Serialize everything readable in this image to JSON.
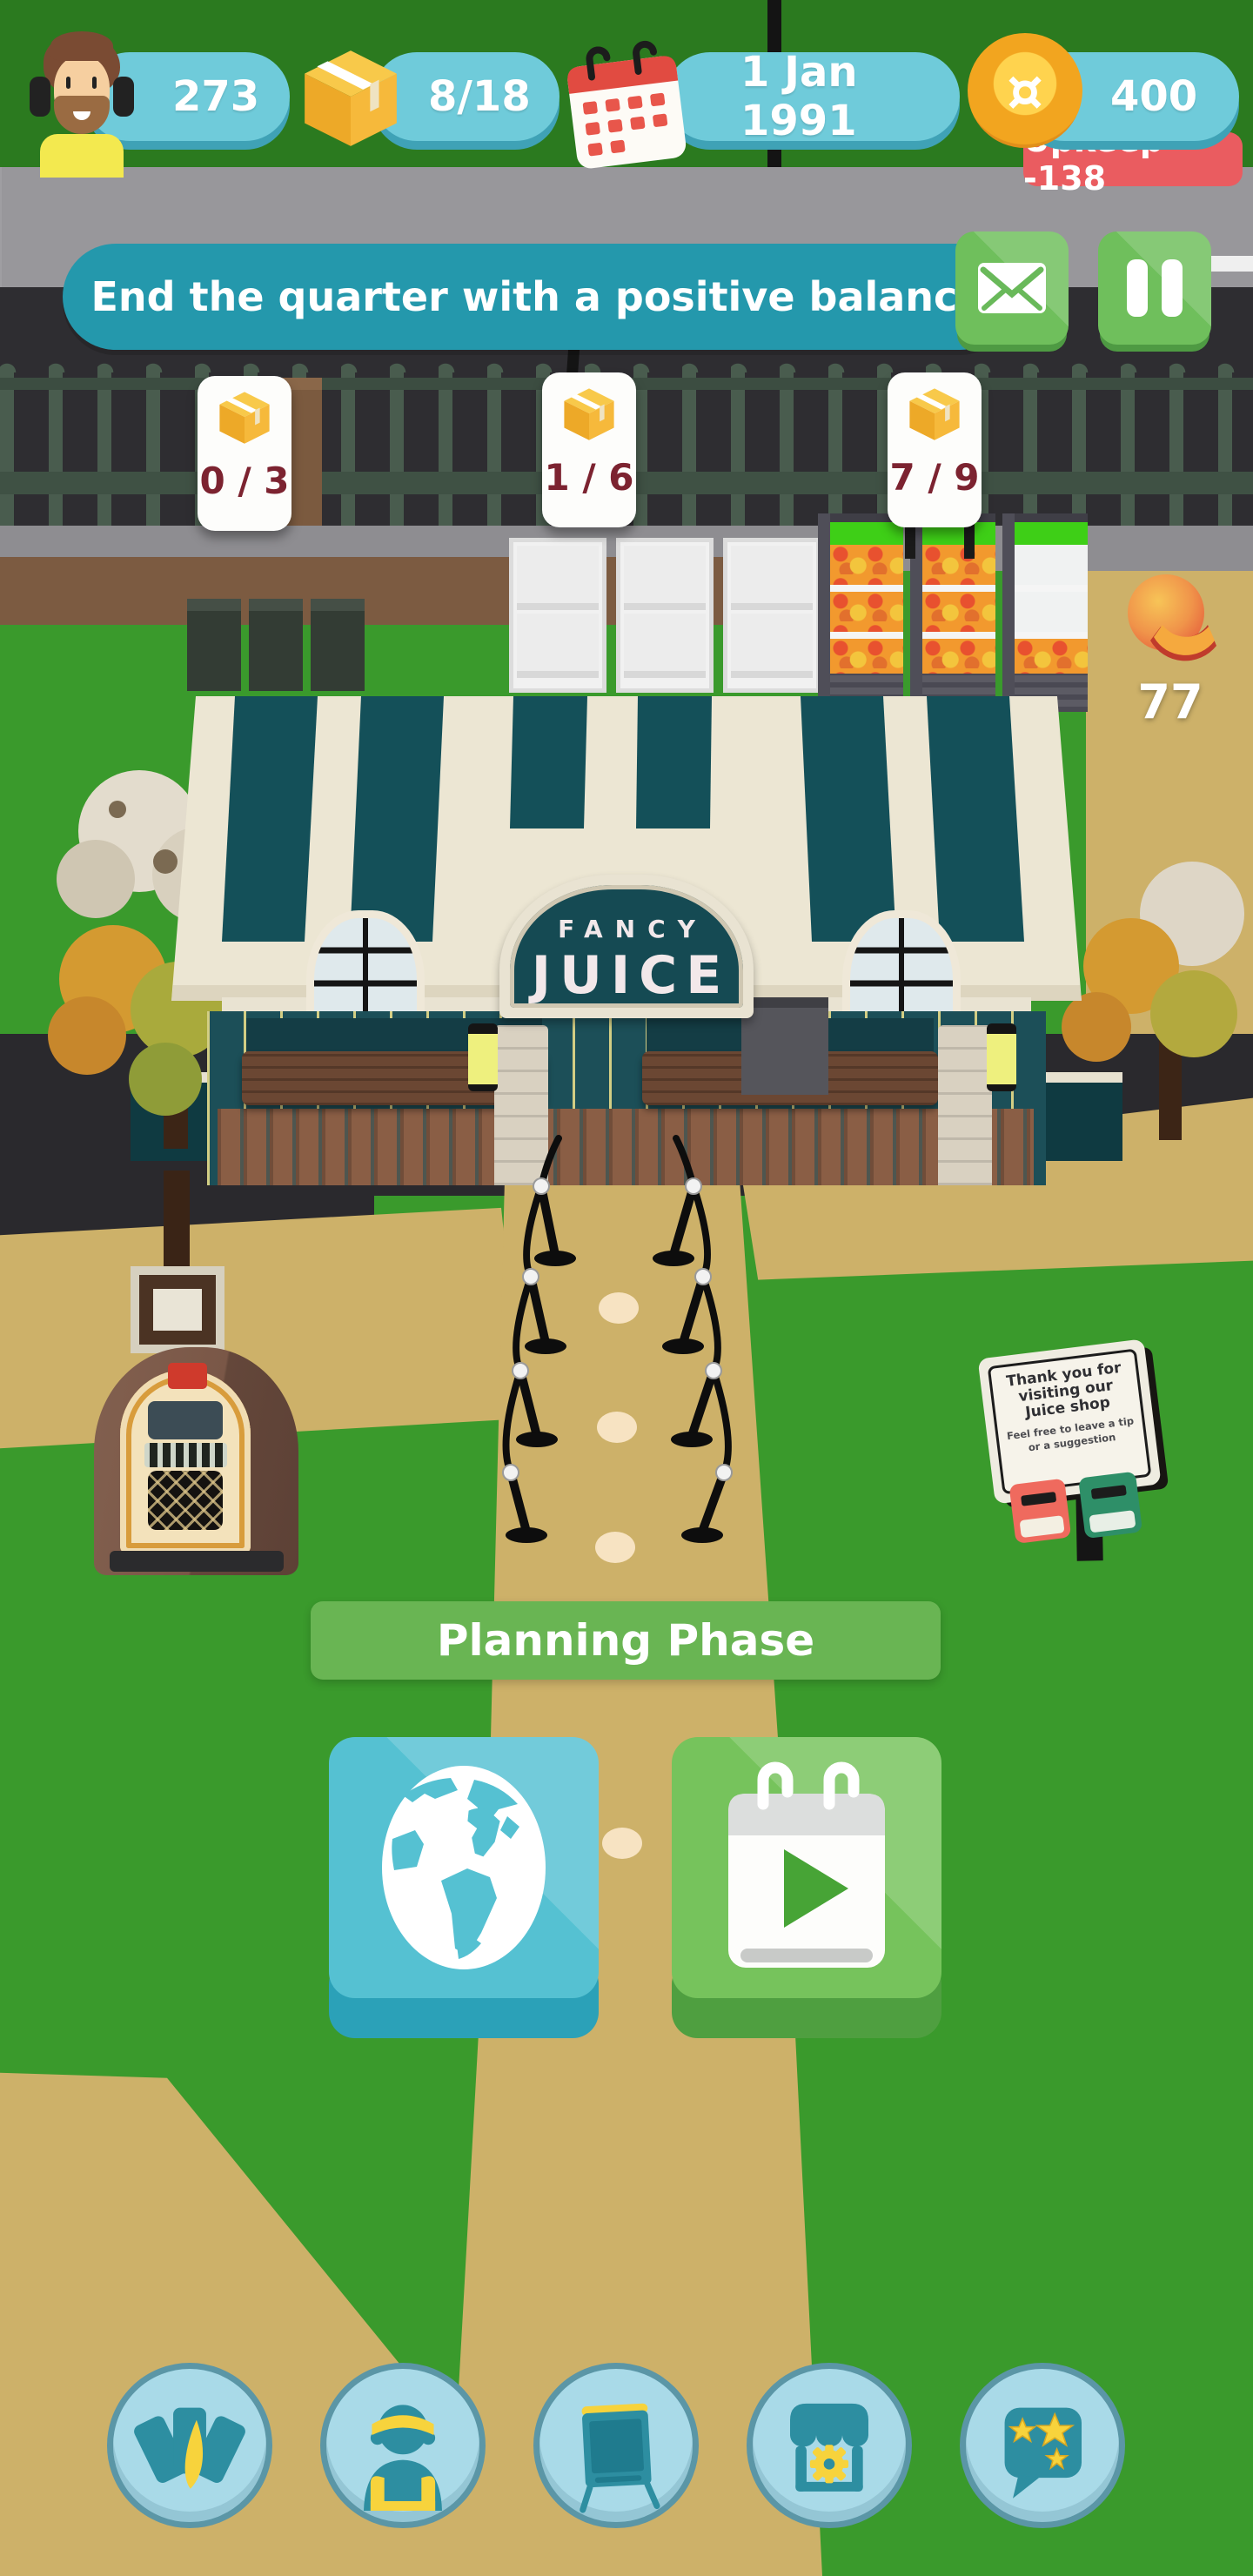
{
  "hud": {
    "avatar_stat": "273",
    "box_stat": "8/18",
    "date": "1 Jan 1991",
    "coin_stat": "400",
    "upkeep": "Upkeep -138"
  },
  "quest": {
    "objective": "End the quarter with a positive balance"
  },
  "stock_badges": [
    {
      "value": "0 / 3"
    },
    {
      "value": "1 / 6"
    },
    {
      "value": "7 / 9"
    }
  ],
  "fruit_counter": {
    "count": "77"
  },
  "shop_sign": {
    "line1": "FANCY",
    "line2": "JUICE"
  },
  "phase_banner": {
    "label": "Planning Phase"
  },
  "tip_sign": {
    "title": "Thank you for visiting our Juice shop",
    "subtitle": "Feel free to leave a tip or a suggestion"
  },
  "icons": {
    "currency_symbol": "¤"
  },
  "colors": {
    "hud_pill": "#6fcbda",
    "hud_pill_edge": "#3fa2b6",
    "quest_banner": "#2498ac",
    "action_green": "#6fbf5c",
    "phase_banner": "#69b553",
    "upkeep_badge": "#ea5c60",
    "globe_button": "#55c1d2",
    "next_button": "#76c35c",
    "toolbar_circle": "#a9dae8",
    "stock_value_color": "#7c2330"
  }
}
